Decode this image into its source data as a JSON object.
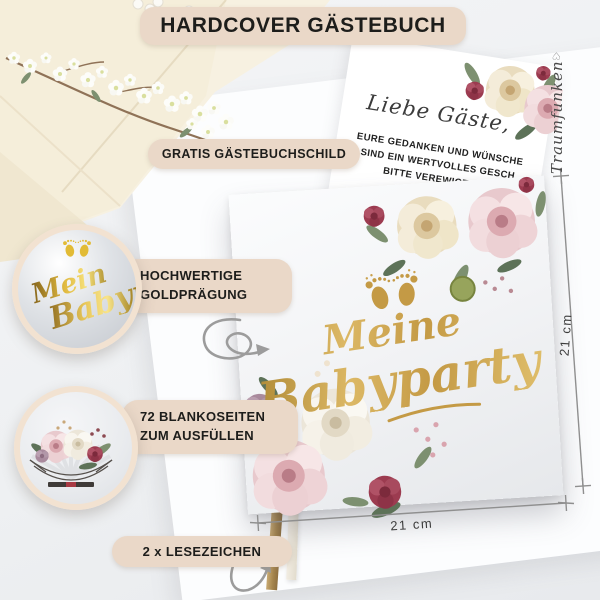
{
  "header": {
    "title": "HARDCOVER GÄSTEBUCH"
  },
  "callouts": {
    "sign": "GRATIS GÄSTEBUCHSCHILD",
    "foil_line1": "HOCHWERTIGE",
    "foil_line2": "GOLDPRÄGUNG",
    "pages_line1": "72 BLANKOSEITEN",
    "pages_line2": "ZUM AUSFÜLLEN",
    "bookmarks": "2 x LESEZEICHEN"
  },
  "insert_card": {
    "greeting": "Liebe Gäste,",
    "line1": "EURE GEDANKEN UND WÜNSCHE",
    "line2": "SIND EIN WERTVOLLES GESCH",
    "line3": "BITTE VEREWIGT SIE"
  },
  "book_cover": {
    "title_line1": "Meine",
    "title_line2": "Babyparty"
  },
  "foil_inset": {
    "line1": "Mein",
    "line2": "Babyp"
  },
  "dimensions": {
    "height_label": "21 cm",
    "width_label": "21 cm"
  },
  "signature": {
    "text": "Traumfunken",
    "heart": "♡"
  },
  "colors": {
    "pill_beige": "#EAD8C8",
    "gold": "#C49A45",
    "foil_gold": "#E8C75A",
    "text_dark": "#1D1D1B",
    "line_gray": "#9C9C9C",
    "burgundy": "#9C3B50",
    "blush": "#EFD6D8",
    "cream_flower": "#EFE4C9",
    "leaf_green": "#7D9070"
  }
}
